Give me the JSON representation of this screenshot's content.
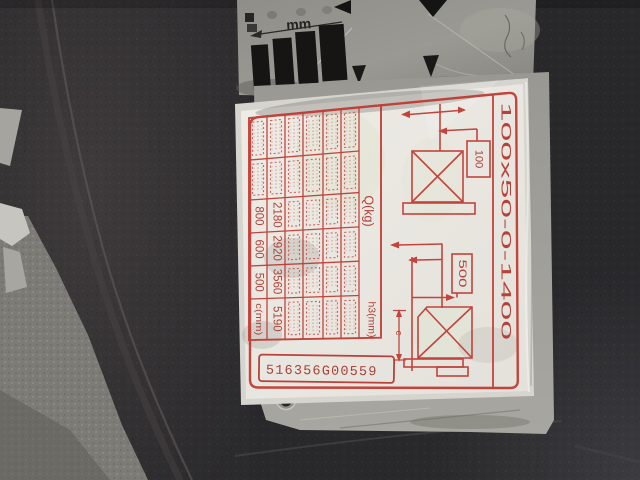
{
  "ruler": {
    "unit": "mm"
  },
  "label": {
    "serial": "516356G00559",
    "fork_spec": "100x50-0-1400",
    "headers": {
      "q": "Q(kg)",
      "h3": "h3(mm)"
    },
    "dims": {
      "upper": "100",
      "lower": "500",
      "load_center": "c"
    },
    "table": {
      "strips": [
        [
          "",
          "",
          "800",
          "600",
          "500",
          "c(mm)"
        ],
        [
          "",
          "",
          "2180",
          "2920",
          "3560",
          "5190"
        ],
        [
          "",
          "",
          "",
          "",
          "",
          ""
        ],
        [
          "",
          "",
          "",
          "",
          "",
          ""
        ],
        [
          "",
          "",
          "",
          "",
          "",
          ""
        ],
        [
          "",
          "",
          "",
          "",
          "",
          ""
        ]
      ]
    },
    "colors": {
      "print_red": "#bf372f",
      "paper": "#edebe4"
    }
  }
}
